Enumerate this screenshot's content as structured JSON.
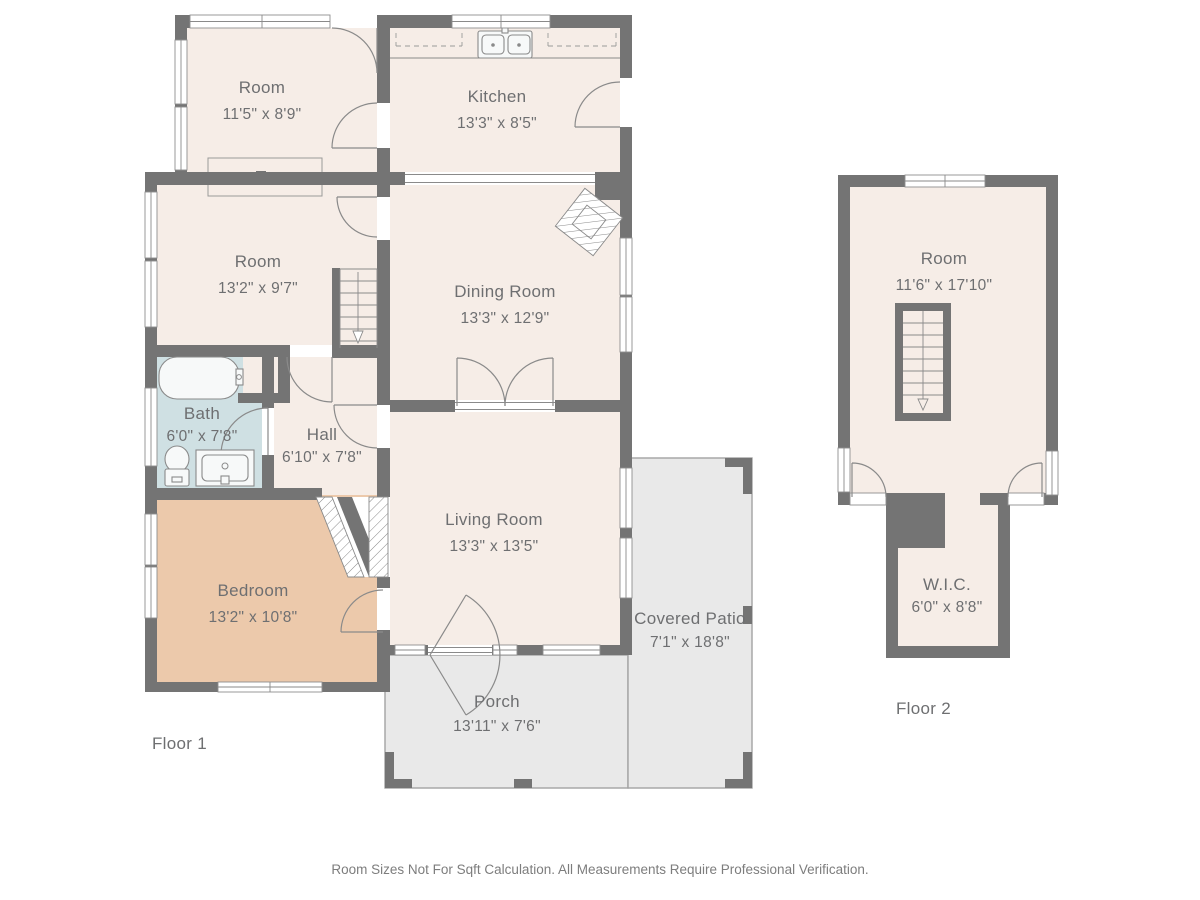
{
  "page": {
    "disclaimer": "Room Sizes Not For Sqft Calculation. All Measurements Require Professional Verification."
  },
  "colors": {
    "wall": "#747474",
    "room_fill": "#f6ede7",
    "bedroom_fill": "#ecc9ab",
    "bath_fill": "#cfe0e3",
    "outdoor_fill": "#e9e9e9",
    "line": "#8a8a8a",
    "text": "#6e6f71"
  },
  "floor1": {
    "label": "Floor 1",
    "rooms": [
      {
        "name": "Room",
        "dims": "11'5\" x 8'9\""
      },
      {
        "name": "Kitchen",
        "dims": "13'3\" x 8'5\""
      },
      {
        "name": "Room",
        "dims": "13'2\" x 9'7\""
      },
      {
        "name": "Dining Room",
        "dims": "13'3\" x 12'9\""
      },
      {
        "name": "Bath",
        "dims": "6'0\" x 7'8\""
      },
      {
        "name": "Hall",
        "dims": "6'10\" x 7'8\""
      },
      {
        "name": "Living Room",
        "dims": "13'3\" x 13'5\""
      },
      {
        "name": "Bedroom",
        "dims": "13'2\" x 10'8\""
      },
      {
        "name": "Covered Patio",
        "dims": "7'1\" x 18'8\""
      },
      {
        "name": "Porch",
        "dims": "13'11\" x 7'6\""
      }
    ]
  },
  "floor2": {
    "label": "Floor 2",
    "rooms": [
      {
        "name": "Room",
        "dims": "11'6\" x 17'10\""
      },
      {
        "name": "W.I.C.",
        "dims": "6'0\" x 8'8\""
      }
    ]
  }
}
